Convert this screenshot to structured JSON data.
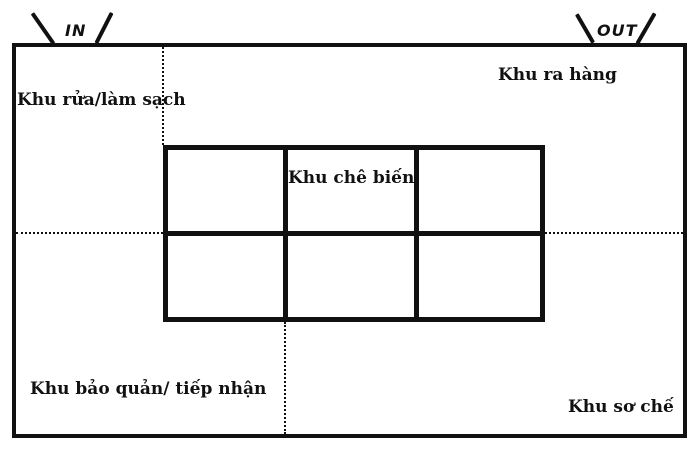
{
  "diagram": {
    "doors": {
      "in": "IN",
      "out": "OUT"
    },
    "areas": {
      "washing": "Khu rửa/làm sạch",
      "dispatch": "Khu ra hàng",
      "processing": "Khu chê biến",
      "storage_receiving": "Khu bảo quản/ tiếp nhận",
      "prep": "Khu sơ chế"
    },
    "grid": {
      "rows": 2,
      "cols": 3
    },
    "colors": {
      "line": "#111111",
      "background": "#ffffff"
    }
  }
}
